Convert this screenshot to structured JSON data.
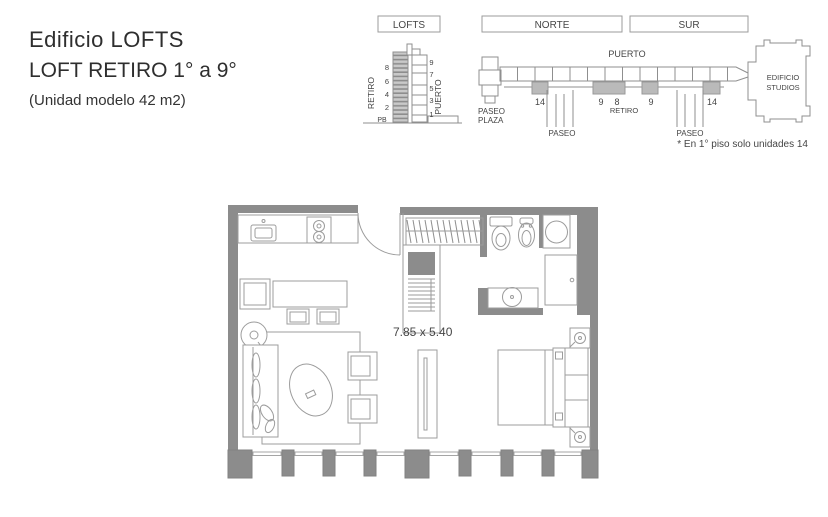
{
  "header": {
    "title": "Edificio LOFTS",
    "subtitle": "LOFT RETIRO 1° a 9°",
    "note": "(Unidad modelo 42 m2)"
  },
  "elevation": {
    "label": "LOFTS",
    "left_street": "RETIRO",
    "right_street": "PUERTO",
    "left_floors": [
      "8",
      "6",
      "4",
      "2"
    ],
    "ground_label": "PB",
    "right_floors": [
      "9",
      "7",
      "5",
      "3",
      "1"
    ]
  },
  "site_plan": {
    "north_label": "NORTE",
    "south_label": "SUR",
    "top_street": "PUERTO",
    "bottom_street": "RETIRO",
    "paseo_plaza_line1": "PASEO",
    "paseo_plaza_line2": "PLAZA",
    "paseo_labels": [
      "PASEO",
      "PASEO"
    ],
    "studios_line1": "EDIFICIO",
    "studios_line2": "STUDIOS",
    "unit_numbers": [
      "14",
      "9",
      "8",
      "9",
      "14"
    ],
    "footnote": "* En 1° piso solo unidades 14"
  },
  "floor_plan": {
    "dimensions_label": "7.85 x 5.40"
  },
  "colors": {
    "wall": "#8c8c8c",
    "shaded_unit": "#bababa",
    "line": "#9b9b9b",
    "text": "#454545"
  }
}
